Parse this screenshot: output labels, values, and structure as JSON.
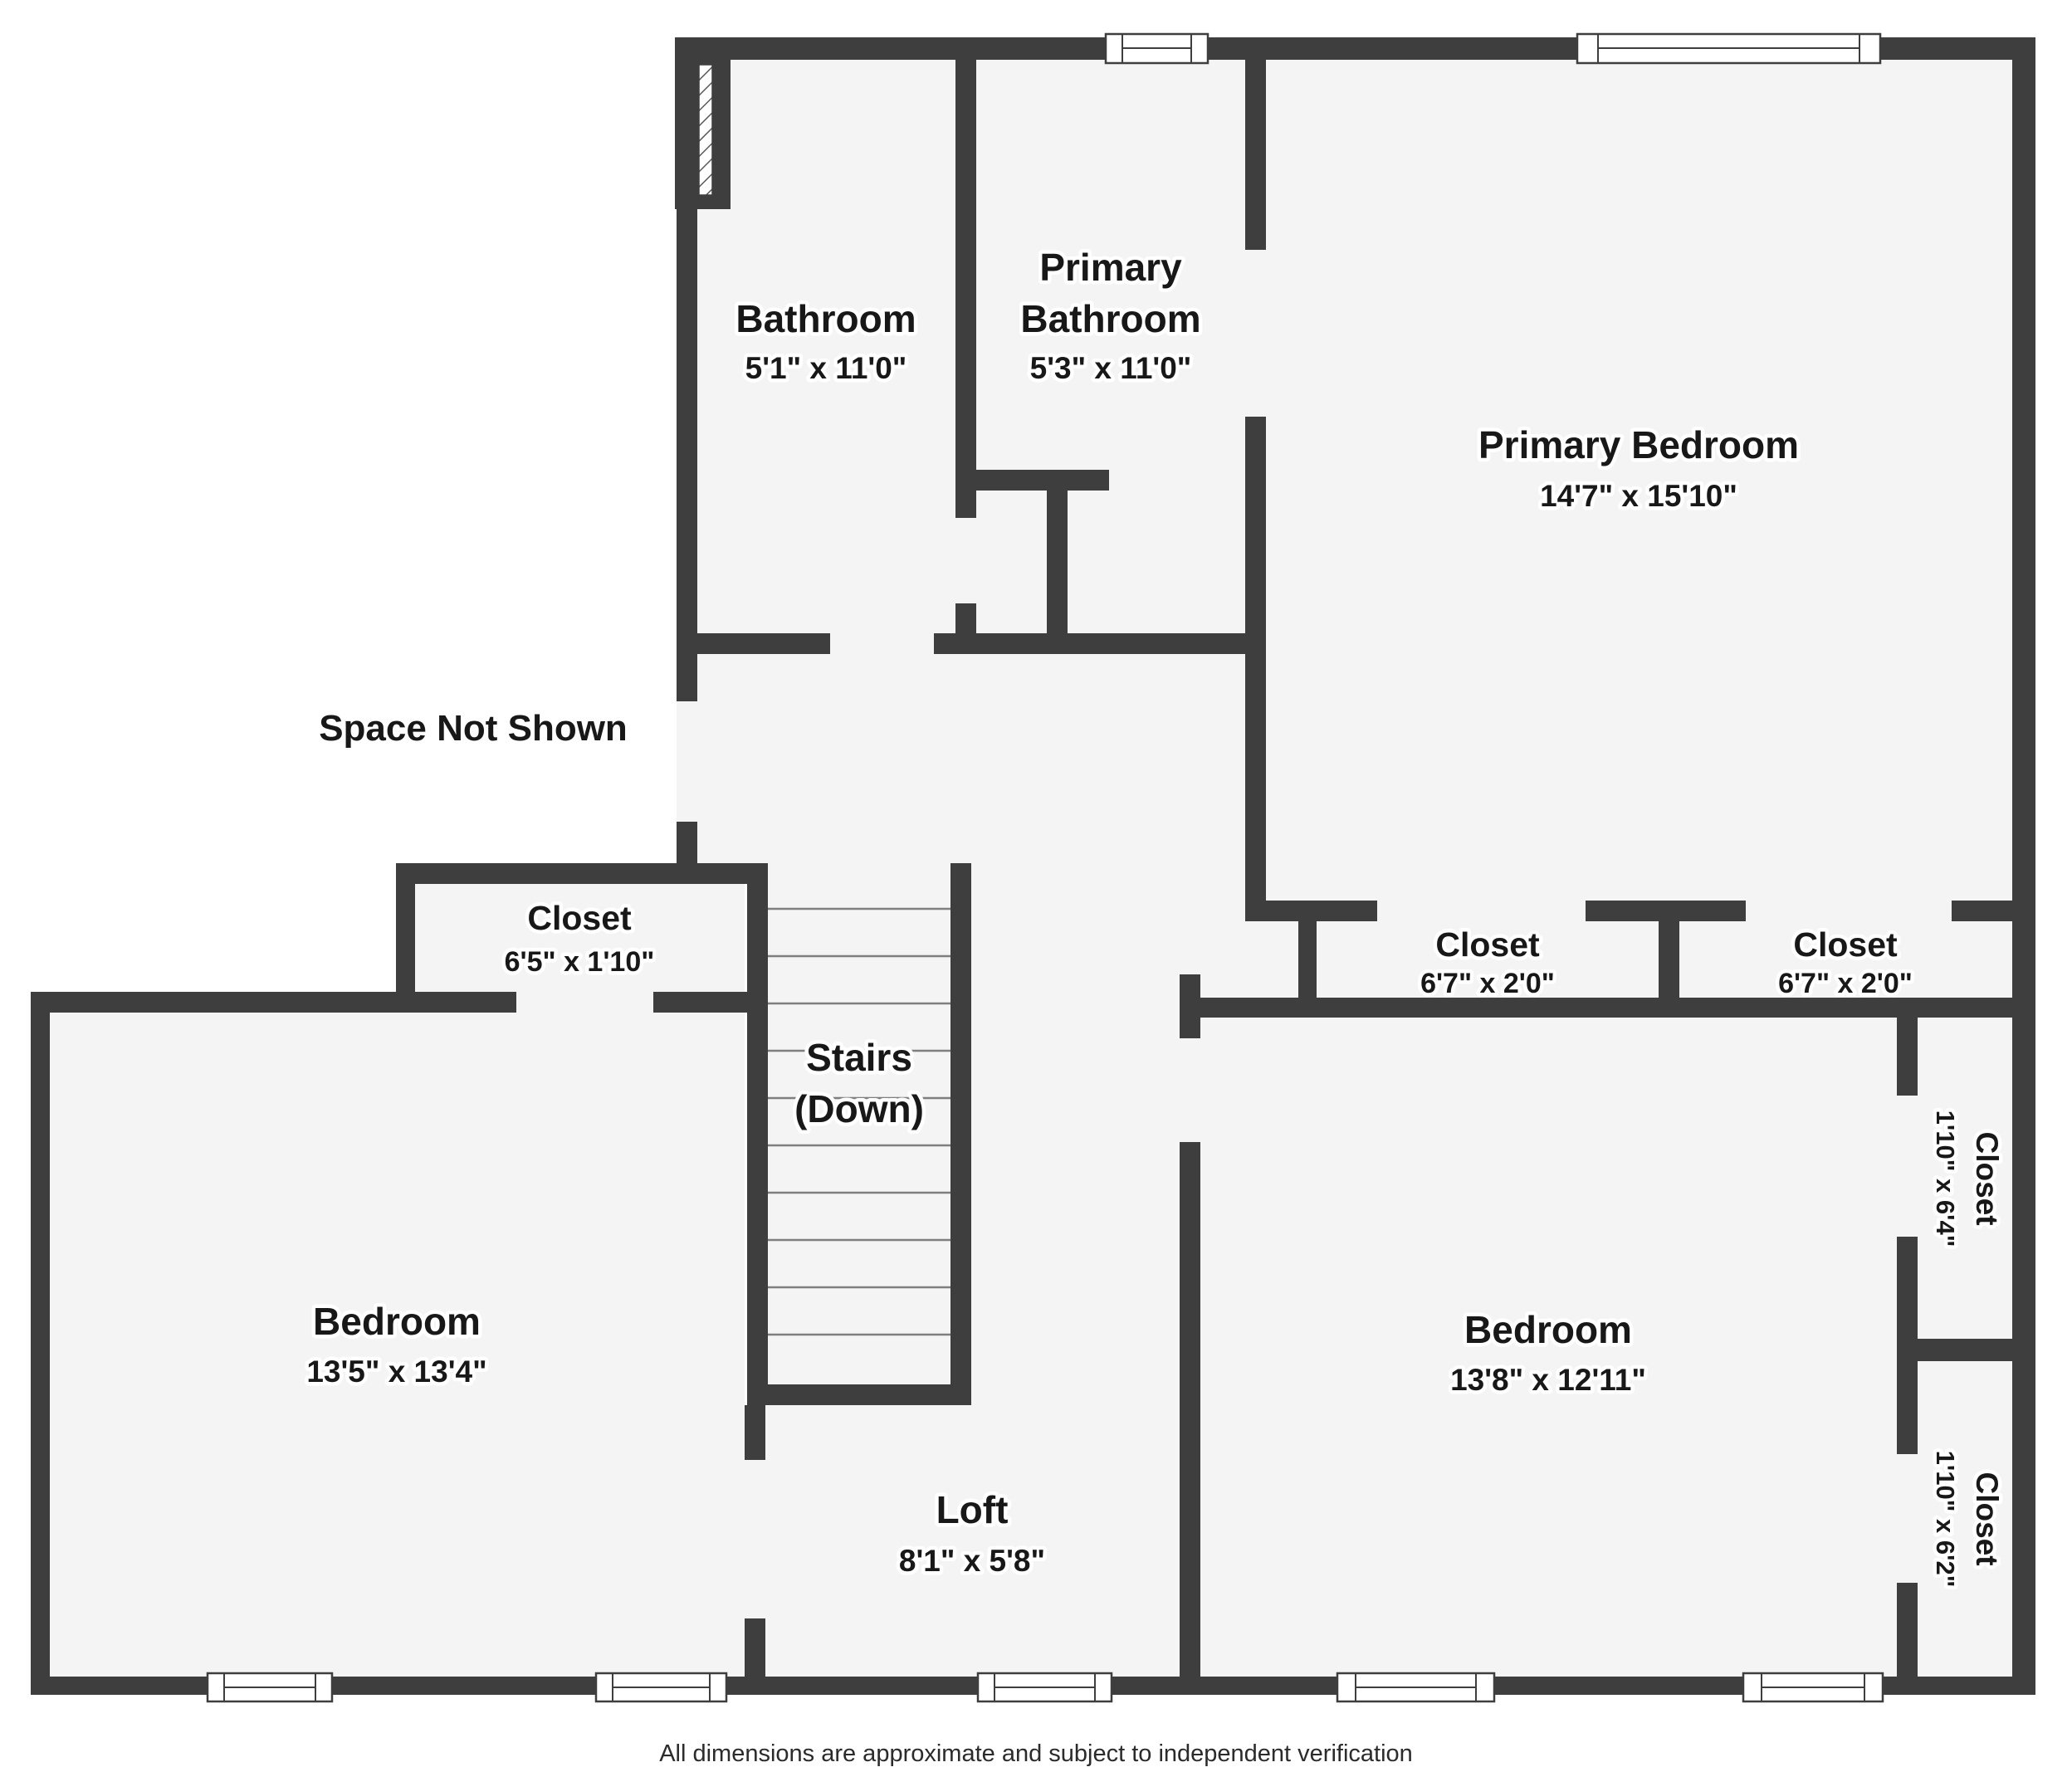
{
  "colors": {
    "wall": "#3e3e3e",
    "room_fill": "#f4f4f4",
    "background": "#ffffff",
    "text": "#181818"
  },
  "rooms": {
    "bathroom": {
      "name": "Bathroom",
      "dims": "5'1\" x 11'0\""
    },
    "primary_bathroom": {
      "name_line1": "Primary",
      "name_line2": "Bathroom",
      "dims": "5'3\" x 11'0\""
    },
    "primary_bedroom": {
      "name": "Primary Bedroom",
      "dims": "14'7\" x 15'10\""
    },
    "closet_hall": {
      "name": "Closet",
      "dims": "6'5\" x 1'10\""
    },
    "stairs": {
      "name_line1": "Stairs",
      "name_line2": "(Down)"
    },
    "bedroom_left": {
      "name": "Bedroom",
      "dims": "13'5\" x 13'4\""
    },
    "closet_primary_left": {
      "name": "Closet",
      "dims": "6'7\" x 2'0\""
    },
    "closet_primary_right": {
      "name": "Closet",
      "dims": "6'7\" x 2'0\""
    },
    "bedroom_right": {
      "name": "Bedroom",
      "dims": "13'8\" x 12'11\""
    },
    "closet_right_upper": {
      "name": "Closet",
      "dims": "1'10\" x 6'4\""
    },
    "closet_right_lower": {
      "name": "Closet",
      "dims": "1'10\" x 6'2\""
    },
    "loft": {
      "name": "Loft",
      "dims": "8'1\" x 5'8\""
    }
  },
  "annotations": {
    "space_not_shown": "Space Not Shown"
  },
  "footer": {
    "disclaimer": "All dimensions are approximate and subject to independent verification"
  }
}
